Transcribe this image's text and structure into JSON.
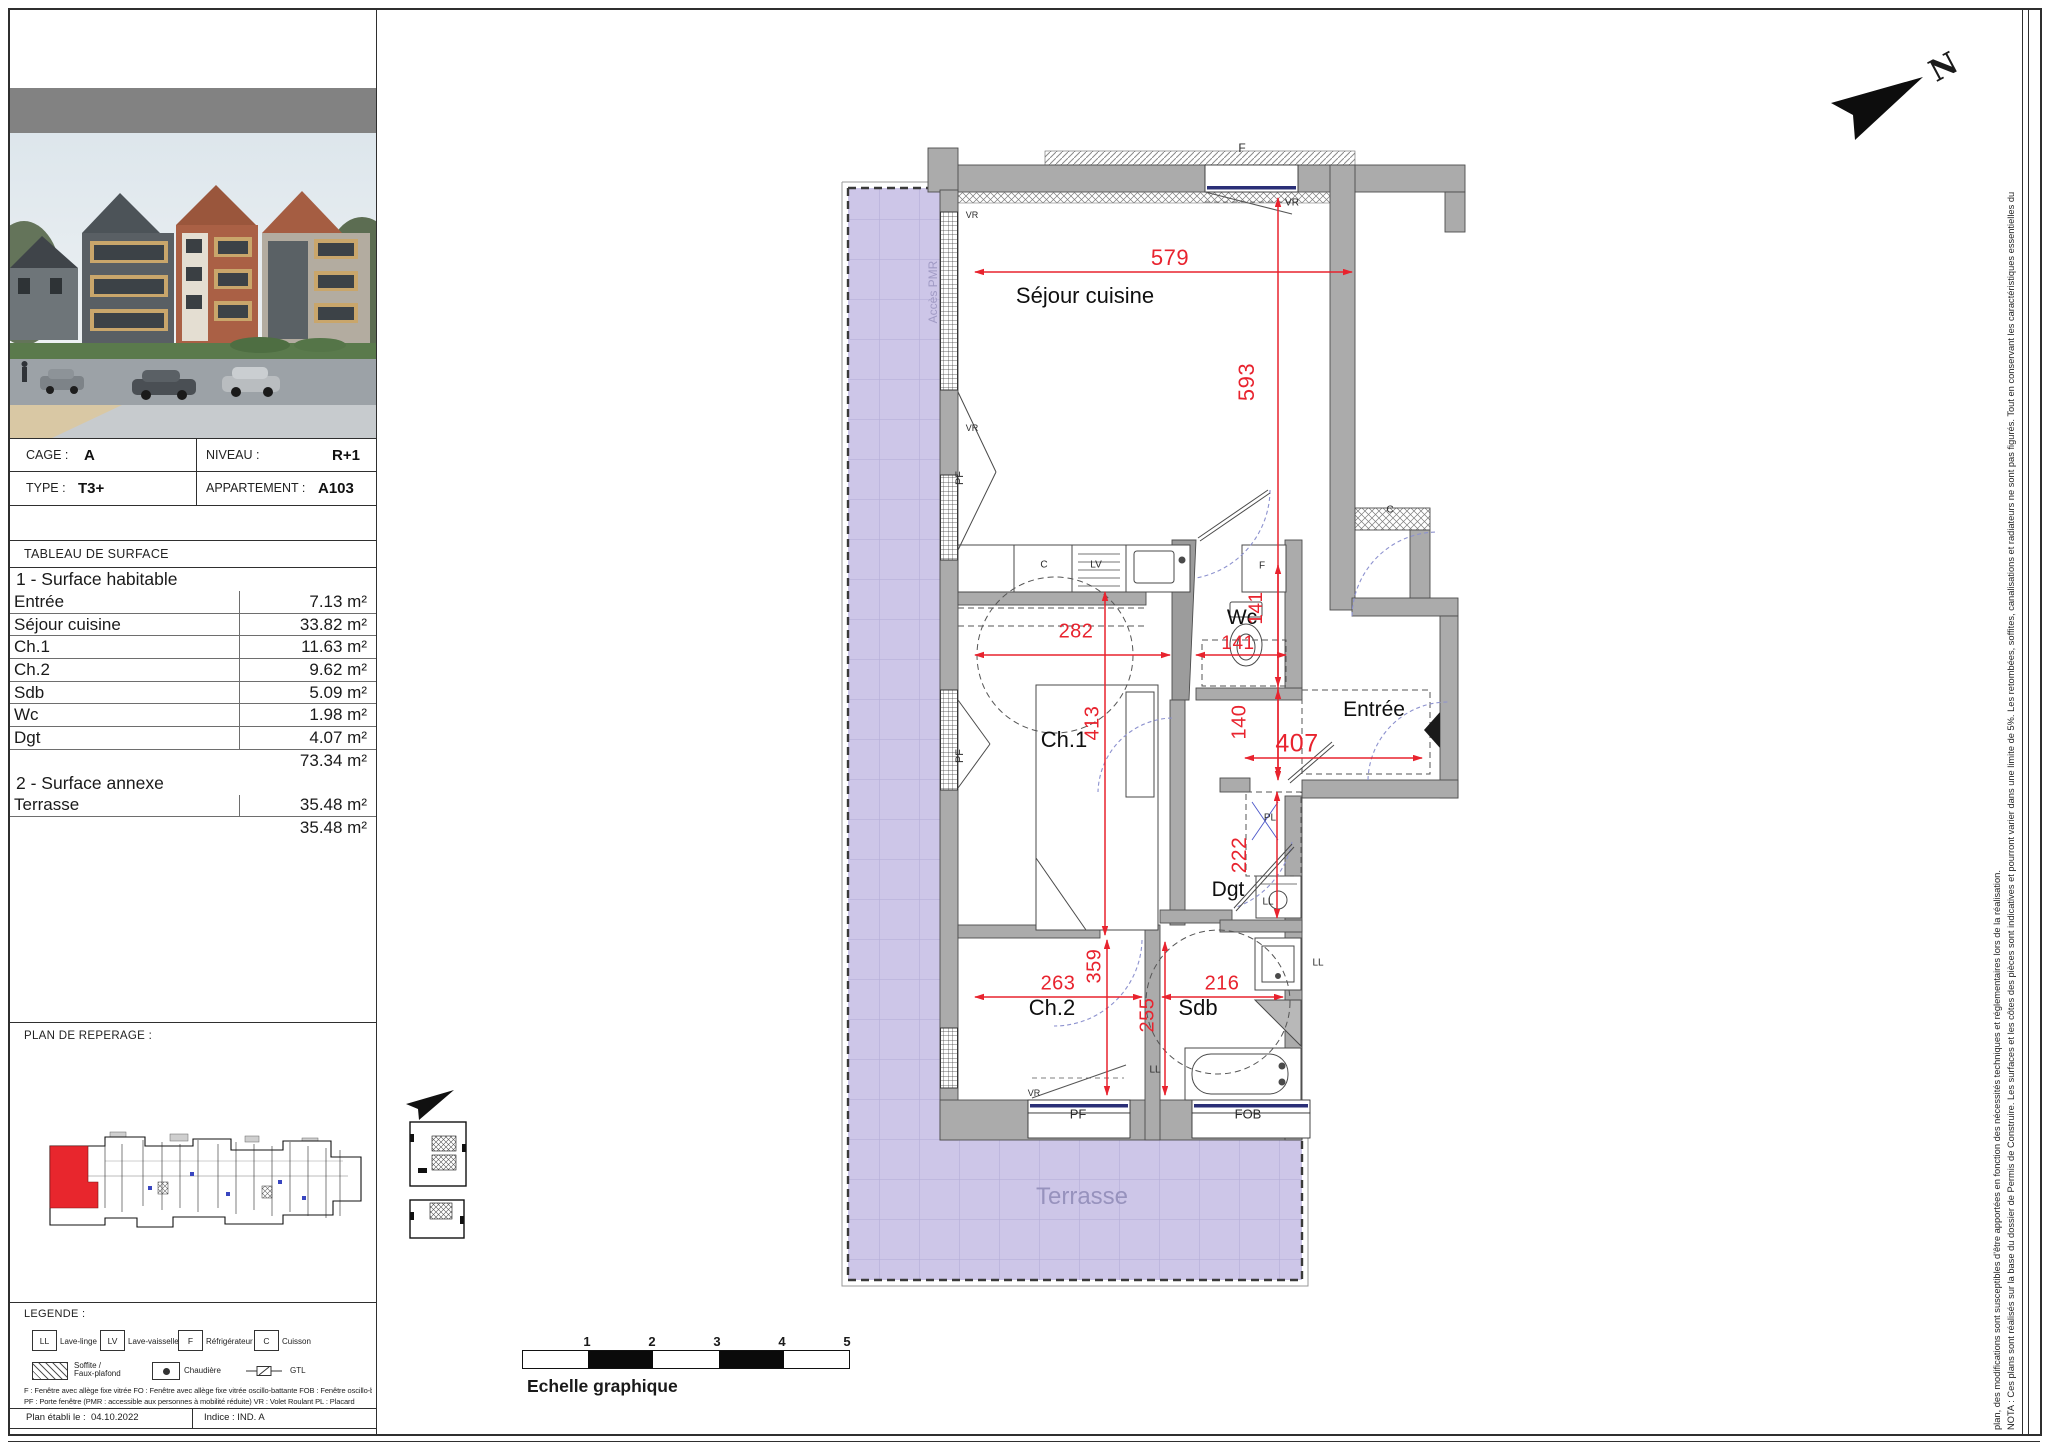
{
  "sheet": {
    "info": {
      "cage_label": "CAGE :",
      "cage_value": "A",
      "niveau_label": "NIVEAU :",
      "niveau_value": "R+1",
      "type_label": "TYPE :",
      "type_value": "T3+",
      "appartement_label": "APPARTEMENT :",
      "appartement_value": "A103"
    },
    "surface_table": {
      "title": "TABLEAU DE SURFACE",
      "section1": "1 - Surface habitable",
      "rows1": [
        {
          "label": "Entrée",
          "value": "7.13 m²"
        },
        {
          "label": "Séjour cuisine",
          "value": "33.82 m²"
        },
        {
          "label": "Ch.1",
          "value": "11.63 m²"
        },
        {
          "label": "Ch.2",
          "value": "9.62 m²"
        },
        {
          "label": "Sdb",
          "value": "5.09 m²"
        },
        {
          "label": "Wc",
          "value": "1.98 m²"
        },
        {
          "label": "Dgt",
          "value": "4.07 m²"
        }
      ],
      "total1": "73.34 m²",
      "section2": "2 - Surface annexe",
      "rows2": [
        {
          "label": "Terrasse",
          "value": "35.48 m²"
        }
      ],
      "total2": "35.48 m²"
    },
    "reperage_title": "PLAN DE REPERAGE :",
    "legende": {
      "title": "LEGENDE :",
      "appliances": [
        {
          "abbr": "LL",
          "label": "Lave-linge"
        },
        {
          "abbr": "LV",
          "label": "Lave-vaisselle"
        },
        {
          "abbr": "F",
          "label": "Réfrigérateur"
        },
        {
          "abbr": "C",
          "label": "Cuisson"
        }
      ],
      "soffite_label": "Soffite /\nFaux-plafond",
      "chaudiere_label": "Chaudière",
      "gtl_label": "GTL",
      "note1": "F : Fenêtre avec allège fixe vitrée      FO : Fenêtre avec allège fixe vitrée oscillo-battante      FOB : Fenêtre oscillo-battante      FT : Fenêtre de toit",
      "note2": "PF : Porte fenêtre (PMR : accessible aux personnes à mobilité réduite)      VR : Volet Roulant      PL : Placard"
    },
    "footer": {
      "date_label": "Plan établi le :",
      "date_value": "04.10.2022",
      "indice_label": "Indice :",
      "indice_value": "IND. A"
    }
  },
  "plan": {
    "rooms": {
      "sejour": "Séjour cuisine",
      "ch1": "Ch.1",
      "ch2": "Ch.2",
      "sdb": "Sdb",
      "wc": "Wc",
      "dgt": "Dgt",
      "entree": "Entrée",
      "terrasse": "Terrasse"
    },
    "dims": {
      "d579": "579",
      "d593": "593",
      "d282": "282",
      "d141": "141",
      "d413": "413",
      "d140": "140",
      "d407": "407",
      "d222": "222",
      "d263": "263",
      "d359": "359",
      "d216": "216",
      "d255": "255"
    },
    "tags": {
      "acces_pmr": "Accès PMR",
      "f": "F",
      "vr": "VR",
      "pf": "PF",
      "fob": "FOB",
      "c": "C",
      "lv": "LV",
      "ll": "LL",
      "pl": "PL"
    }
  },
  "scalebar": {
    "label": "Echelle graphique",
    "ticks": [
      "1",
      "2",
      "3",
      "4",
      "5"
    ]
  },
  "nota": {
    "line1": "NOTA : Ces plans sont réalisés sur la base du dossier de Permis de Construire. Les surfaces et les côtes des pièces sont indicatives et pourront varier dans une limite de 5%. Les retombées, soffites, canalisations et radiateurs ne sont pas figurés. Tout en conservant les caractéristiques essentielles du",
    "line2": "plan, des modifications sont susceptibles d'être apportées en fonction des nécessités techniques et réglementaires lors de la réalisation."
  },
  "north": {
    "letter": "N"
  },
  "colors": {
    "dim_red": "#e8232e",
    "terrace": "#cdc6e8",
    "wall_gray": "#ababab",
    "unit_red": "#e8262d"
  }
}
